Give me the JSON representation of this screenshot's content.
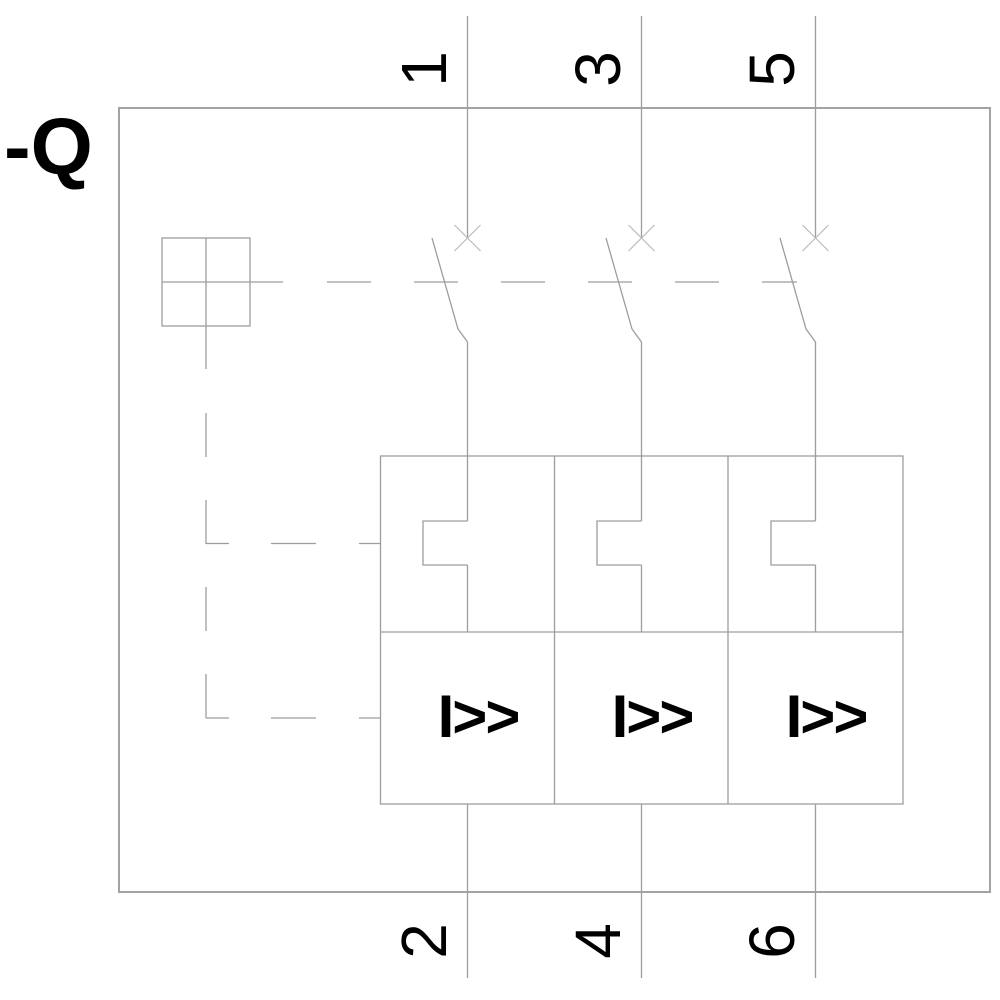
{
  "device": {
    "label": "-Q",
    "kind": "3-pole circuit breaker with thermal and magnetic releases"
  },
  "poles": [
    {
      "top_terminal": "1",
      "bottom_terminal": "2",
      "magnetic_release_label": "I>>"
    },
    {
      "top_terminal": "3",
      "bottom_terminal": "4",
      "magnetic_release_label": "I>>"
    },
    {
      "top_terminal": "5",
      "bottom_terminal": "6",
      "magnetic_release_label": "I>>"
    }
  ],
  "icons": {
    "contact_cross": "breaker-function-cross-icon",
    "operating_mechanism": "mechanism-square-icon",
    "thermal_release": "thermal-overload-notch-icon",
    "mechanical_linkage": "dashed-linkage-line"
  },
  "colors": {
    "line": "#9d9d9d",
    "border": "#a3a3a3",
    "contact_cross": "#bcbcbc",
    "text": "#000000",
    "background": "#ffffff"
  }
}
